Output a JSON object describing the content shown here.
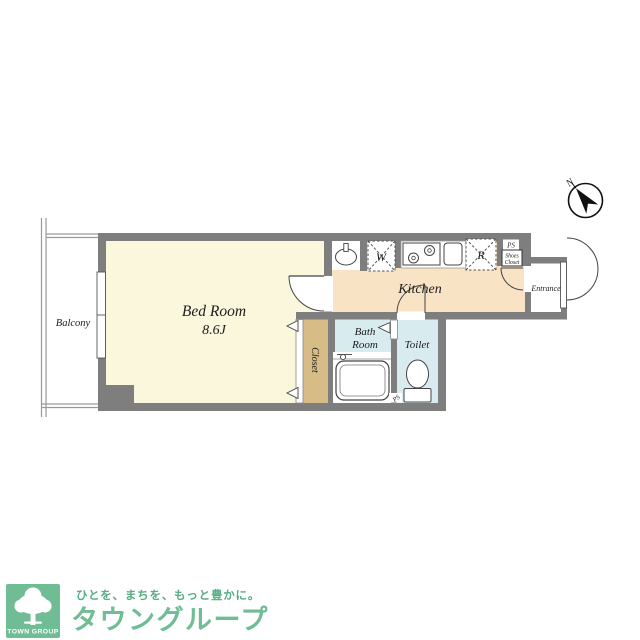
{
  "plan": {
    "compass": {
      "north_label": "N"
    },
    "balcony": {
      "label": "Balcony"
    },
    "bedroom": {
      "label": "Bed Room",
      "size": "8.6J"
    },
    "kitchen": {
      "label": "Kitchen"
    },
    "bath": {
      "label_line1": "Bath",
      "label_line2": "Room"
    },
    "toilet": {
      "label": "Toilet"
    },
    "closet": {
      "label": "Closet"
    },
    "entrance": {
      "label": "Entrance"
    },
    "shoes_closet": {
      "line1": "Shoes",
      "line2": "Closet"
    },
    "ps_top": "PS",
    "ps_bath": "PS",
    "washer_box": "W",
    "fridge_box": "R",
    "colors": {
      "wall": "#7E7E7E",
      "bedroom_floor": "#FAF7DC",
      "kitchen_floor": "#F8E4C5",
      "bath_floor": "#D8ECEF",
      "closet_fill": "#D8BC87",
      "logo_green": "#70BD95",
      "tagline_green": "#55AD82"
    }
  },
  "footer": {
    "logo_text": "TOWN GROUP",
    "tagline": "ひとを、まちを、もっと豊かに。",
    "brand": "タウングループ"
  }
}
